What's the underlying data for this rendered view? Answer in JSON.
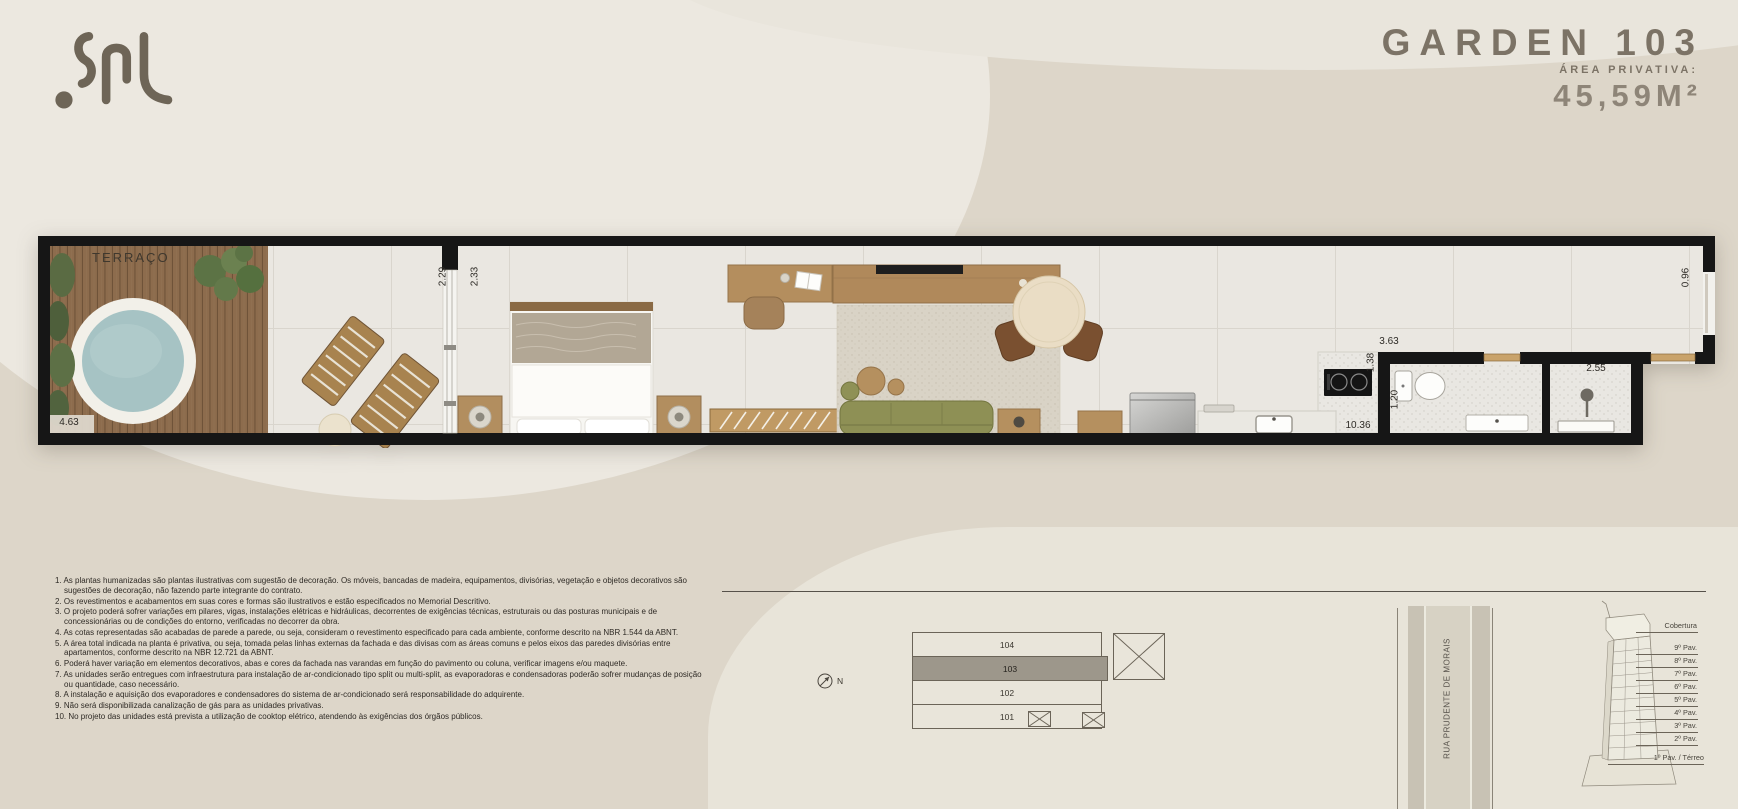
{
  "header": {
    "logo": "SAL",
    "title": "GARDEN 103",
    "area_label": "ÁREA PRIVATIVA:",
    "area_value": "45,59M²"
  },
  "floorplan": {
    "terrace_label": "TERRAÇO",
    "dimensions": {
      "terrace_door_left": "2.29",
      "terrace_door_right": "2.33",
      "kitchen_width": "3.63",
      "kitchen_depth": "1.38",
      "living_length": "10.36",
      "bathroom_width": "1.20",
      "shower_width": "2.55",
      "entry_width": "0.96",
      "terrace_width": "4.63"
    }
  },
  "notes": [
    "1. As plantas humanizadas são plantas ilustrativas com sugestão de decoração. Os móveis, bancadas de madeira, equipamentos, divisórias, vegetação e objetos decorativos são sugestões de decoração, não fazendo parte integrante do contrato.",
    "2. Os revestimentos e acabamentos em suas cores e formas são ilustrativos e estão especificados no Memorial Descritivo.",
    "3. O projeto poderá sofrer variações em pilares, vigas, instalações elétricas e hidráulicas, decorrentes de exigências técnicas, estruturais ou das posturas municipais e de concessionárias ou de condições do entorno, verificadas no decorrer da obra.",
    "4. As cotas representadas são acabadas de parede a parede, ou seja, consideram o revestimento especificado para cada ambiente, conforme descrito na NBR 1.544 da ABNT.",
    "5. A área total indicada na planta é privativa, ou seja, tomada pelas linhas externas da fachada e das divisas com as áreas comuns e pelos eixos das paredes divisórias entre apartamentos, conforme descrito na NBR 12.721 da ABNT.",
    "6. Poderá haver variação em elementos decorativos, abas e cores da fachada nas varandas em função do pavimento ou coluna, verificar imagens e/ou maquete.",
    "7. As unidades serão entregues com infraestrutura para instalação de ar-condicionado tipo split ou multi-split, as evaporadoras e condensadoras poderão sofrer mudanças de posição ou quantidade, caso necessário.",
    "8. A instalação e aquisição dos evaporadores e condensadores do sistema de ar-condicionado será responsabilidade do adquirente.",
    "9. Não será disponibilizada canalização de gás para as unidades privativas.",
    "10. No projeto das unidades está prevista a utilização de cooktop elétrico, atendendo às exigências dos órgãos públicos."
  ],
  "keyplan": {
    "units": [
      "104",
      "103",
      "102",
      "101"
    ],
    "highlighted_unit": "103",
    "north_label": "N",
    "street_name": "RUA PRUDENTE DE MORAIS",
    "floors": [
      "Cobertura",
      "9º Pav.",
      "8º Pav.",
      "7º Pav.",
      "6º Pav.",
      "5º Pav.",
      "4º Pav.",
      "3º Pav.",
      "2º Pav.",
      "1º Pav. / Térreo"
    ]
  },
  "colors": {
    "background": "#DDD6C9",
    "background_light": "#ECE8E0",
    "title_text": "#7C7366",
    "walls": "#161616",
    "pool_water": "#A6C3C4",
    "deck_wood": "#8D6C4D",
    "sofa_olive": "#8E9055",
    "highlighted_unit_fill": "#9D978B"
  }
}
